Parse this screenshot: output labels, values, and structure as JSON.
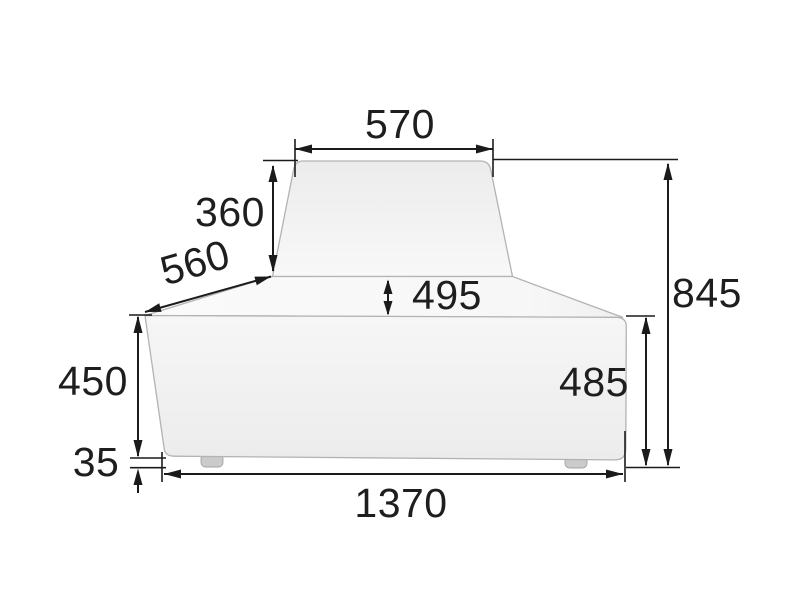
{
  "drawing": {
    "title": "furniture-dimension-drawing",
    "subject": "lounge-seat-module-front-elevation",
    "background_color": "#ffffff",
    "dimension_line_color": "#1b1b1b",
    "label_text_color": "#1e1e1e",
    "body_outline_color": "#b3b3b3",
    "body_fill_top": "#ececec",
    "body_fill_light": "#f9f9f9",
    "body_fill_front": "#efefef",
    "foot_fill": "#cbcbcb",
    "labels": {
      "top_width": "570",
      "backrest_height": "360",
      "side_depth": "560",
      "seat_top_depth": "495",
      "overall_height": "845",
      "seat_height": "450",
      "body_height": "485",
      "foot_height": "35",
      "overall_width": "1370"
    }
  }
}
